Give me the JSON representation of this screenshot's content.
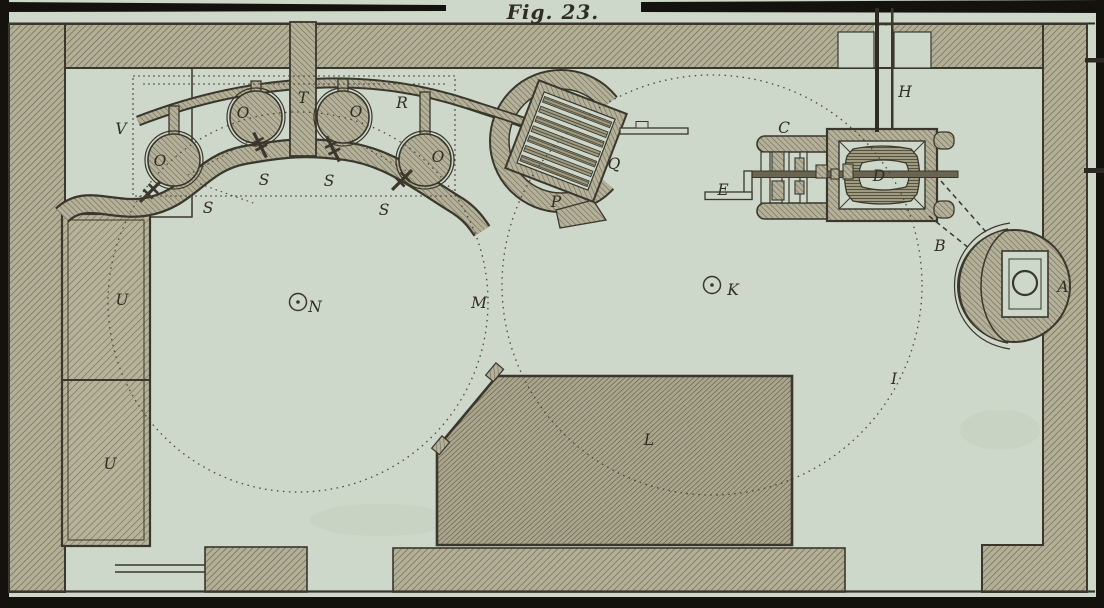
{
  "figure": {
    "title": "Fig. 23."
  },
  "part_labels": {
    "A": "A",
    "B": "B",
    "C": "C",
    "D": "D",
    "E": "E",
    "H": "H",
    "I": "I",
    "K": "K",
    "L": "L",
    "M": "M",
    "N": "N",
    "O": "O",
    "P": "P",
    "Q": "Q",
    "R": "R",
    "S": "S",
    "T": "T",
    "U": "U",
    "V": "V"
  },
  "colors": {
    "paper": "#cdd7ca",
    "hatch_fill": "#b2af97",
    "hatch_line": "#6c6751",
    "ink_outline": "#3a372c",
    "plate_border": "#14120c",
    "label_ink": "#2f2d24",
    "dotted_guide": "#4a473d"
  }
}
